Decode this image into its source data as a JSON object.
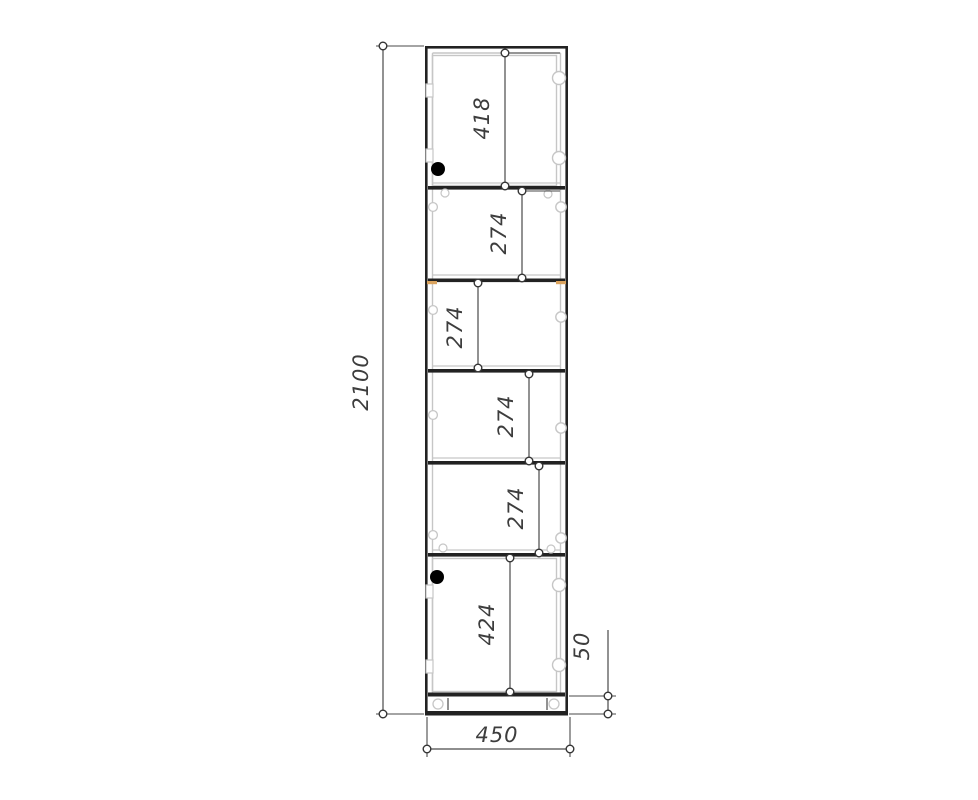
{
  "page": {
    "background": "#ffffff"
  },
  "drawing": {
    "kind": "furniture-front-view-technical-drawing",
    "units": "mm",
    "overall": {
      "height": "2100",
      "width": "450",
      "plinth": "50"
    },
    "compartment_heights": [
      "418",
      "274",
      "274",
      "274",
      "274",
      "424"
    ],
    "colors": {
      "line_dark": "#222222",
      "line_medium": "#4a4a4a",
      "line_light": "#c6c6c6",
      "accent_wood": "#dba45f",
      "text": "#3d3d3d",
      "lock_dot": "#000000"
    },
    "cabinet": {
      "outer": {
        "x1": 425,
        "y1": 46,
        "x2": 568,
        "y2": 715
      },
      "inner_left_x": 432.5,
      "inner_right_x": 560.5,
      "inner_top_y": 53,
      "shelves_y": [
        186,
        278.5,
        369,
        461,
        553
      ],
      "shelf_highlights_y": [
        183,
        275,
        366,
        458,
        550
      ],
      "bottom_panel_y": 692.5,
      "plinth_band_y": 711,
      "door_rects": [
        {
          "x": 432.5,
          "y": 55.5,
          "w": 124,
          "h": 130
        },
        {
          "x": 432.5,
          "y": 558.5,
          "w": 124,
          "h": 133
        }
      ],
      "plinth_ticks": [
        [
          448,
          698,
          448,
          710
        ],
        [
          547,
          698,
          547,
          710
        ]
      ]
    },
    "hardware": {
      "cam_circles_large": [
        [
          559,
          78
        ],
        [
          559,
          158
        ],
        [
          559,
          585
        ],
        [
          559,
          665
        ]
      ],
      "cam_circles_small": [
        [
          561,
          207
        ],
        [
          561,
          317
        ],
        [
          561,
          428
        ],
        [
          561,
          538
        ]
      ],
      "pin_circles_left": [
        [
          433,
          207
        ],
        [
          433,
          310
        ],
        [
          433,
          415
        ],
        [
          433,
          535
        ]
      ],
      "shelf_front_pins": [
        [
          445,
          193
        ],
        [
          548,
          194
        ],
        [
          443,
          548
        ],
        [
          551,
          549
        ]
      ],
      "plinth_brackets": [
        [
          438,
          704
        ],
        [
          554,
          704
        ]
      ],
      "hinge_plates": [
        [
          426,
          84
        ],
        [
          426,
          149
        ],
        [
          426,
          585
        ],
        [
          426,
          660
        ]
      ],
      "accent_marks": [
        [
          427,
          281,
          10,
          3.2
        ],
        [
          556,
          281,
          10,
          3.2
        ]
      ],
      "lock_dots": [
        [
          438,
          169
        ],
        [
          437,
          577
        ]
      ]
    },
    "dimensions": [
      {
        "id": "overall-height",
        "value": "2100",
        "axis": "v",
        "x": 383,
        "y1": 46,
        "y2": 714,
        "lx": 368,
        "ly": 382,
        "ext": [
          [
            376,
            46,
            424,
            46
          ],
          [
            376,
            714,
            424,
            714
          ]
        ]
      },
      {
        "id": "top-door-height",
        "value": "418",
        "axis": "v",
        "x": 505,
        "y1": 53,
        "y2": 186,
        "lx": 489,
        "ly": 118,
        "ext": [
          [
            505,
            53,
            560,
            53
          ]
        ]
      },
      {
        "id": "shelf-gap-1",
        "value": "274",
        "axis": "v",
        "x": 522,
        "y1": 191,
        "y2": 278,
        "lx": 506,
        "ly": 233,
        "ext": [
          [
            522,
            191,
            560,
            191
          ]
        ]
      },
      {
        "id": "shelf-gap-2",
        "value": "274",
        "axis": "v",
        "x": 478,
        "y1": 283,
        "y2": 368,
        "lx": 462,
        "ly": 327,
        "ext": []
      },
      {
        "id": "shelf-gap-3",
        "value": "274",
        "axis": "v",
        "x": 529,
        "y1": 374,
        "y2": 461,
        "lx": 513,
        "ly": 416,
        "ext": []
      },
      {
        "id": "shelf-gap-4",
        "value": "274",
        "axis": "v",
        "x": 539,
        "y1": 466,
        "y2": 553,
        "lx": 523,
        "ly": 508,
        "ext": []
      },
      {
        "id": "bottom-door-height",
        "value": "424",
        "axis": "v",
        "x": 510,
        "y1": 558,
        "y2": 692,
        "lx": 494,
        "ly": 624,
        "ext": []
      },
      {
        "id": "plinth-height",
        "value": "50",
        "axis": "v",
        "x": 608,
        "y1": 696,
        "y2": 714,
        "lineFrom": 630,
        "lx": 589,
        "ly": 646,
        "ext": [
          [
            569,
            696,
            616,
            696
          ],
          [
            569,
            714,
            616,
            714
          ]
        ]
      },
      {
        "id": "overall-width",
        "value": "450",
        "axis": "h",
        "y": 749,
        "x1": 427,
        "x2": 570,
        "lx": 497,
        "ly": 742,
        "ext": [
          [
            427,
            717,
            427,
            757
          ],
          [
            570,
            717,
            570,
            757
          ]
        ]
      }
    ]
  }
}
